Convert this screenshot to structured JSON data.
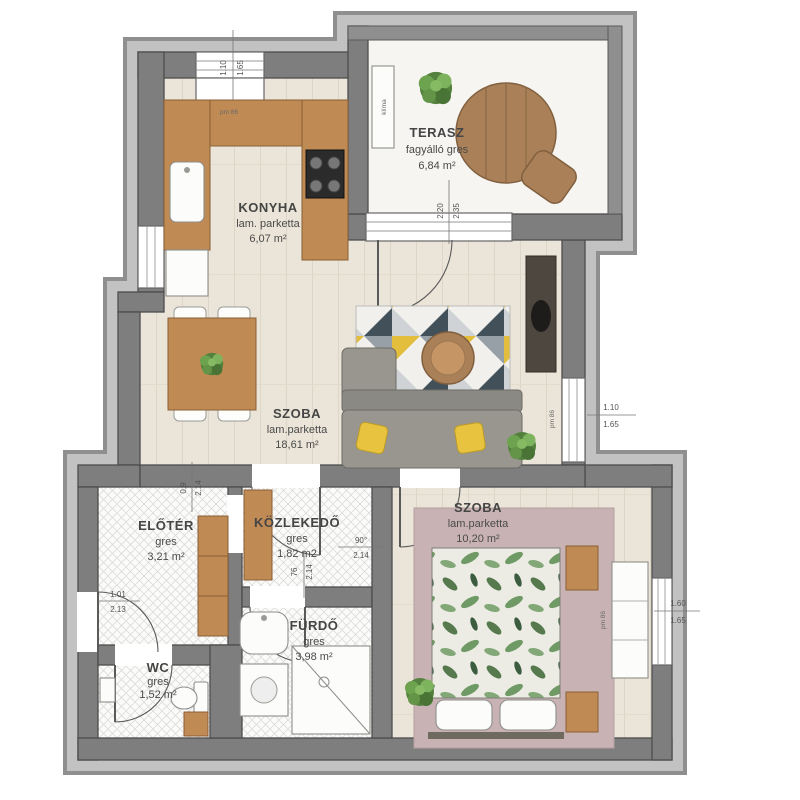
{
  "rooms": [
    {
      "name": "KONYHA",
      "floor": "lam. parketta",
      "area": "6,07 m²"
    },
    {
      "name": "TERASZ",
      "floor": "fagyálló gres",
      "area": "6,84 m²"
    },
    {
      "name": "SZOBA",
      "floor": "lam.parketta",
      "area": "18,61 m²"
    },
    {
      "name": "SZOBA",
      "floor": "lam.parketta",
      "area": "10,20 m²"
    },
    {
      "name": "ELŐTÉR",
      "floor": "gres",
      "area": "3,21 m²"
    },
    {
      "name": "KÖZLEKEDŐ",
      "floor": "gres",
      "area": "1,82 m2"
    },
    {
      "name": "FÜRDŐ",
      "floor": "gres",
      "area": "3,98 m²"
    },
    {
      "name": "WC",
      "floor": "gres",
      "area": "1,52 m²"
    }
  ],
  "labels": {
    "klima": "klíma",
    "pm86": "pm 86"
  },
  "dims": {
    "top_window": {
      "a": "1.10",
      "b": "1.65"
    },
    "terasz_door": {
      "a": "2.20",
      "b": "2.35"
    },
    "living_window": {
      "a": "1.10",
      "b": "1.65"
    },
    "bedroom_window": {
      "a": "1.60",
      "b": "1.65"
    },
    "entry": {
      "a": "1.01",
      "b": "2.13"
    },
    "bedroom_door": {
      "a": "90°",
      "b": "2.14"
    },
    "hall_door": {
      "a": "0.9",
      "b": "2.14"
    },
    "bath_door": {
      "a": "76",
      "b": "2.14"
    }
  },
  "colors": {
    "wall": "#7e7e7e",
    "wood": "#c08a54",
    "sofa_gray": "#98968f",
    "accent_yellow": "#e7c33f",
    "rug_dark": "#42505a",
    "rug_gray": "#97a0a6",
    "bedroom_rug": "#c8b2b4",
    "plant_green": "#55813f",
    "floor_parketta": "#ebe5d9",
    "floor_gres": "#fbfbfa"
  }
}
